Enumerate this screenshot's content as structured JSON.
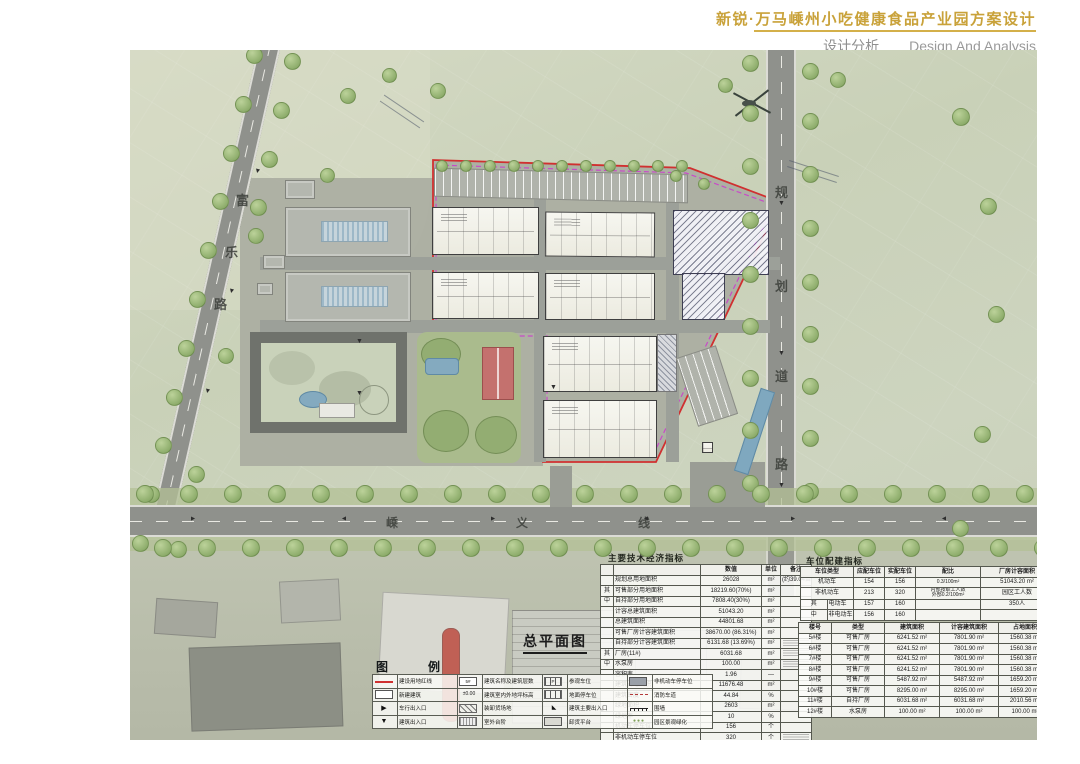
{
  "colors": {
    "accent_gold": "#C9A23A",
    "red_line": "#D03030",
    "magenta_line": "#C84BC8",
    "water": "#84AABF",
    "court_red": "#C4716E"
  },
  "header": {
    "project_title": "新锐·万马嵊州小吃健康食品产业园方案设计",
    "section_cn": "设计分析",
    "section_en": "Design And Analysis",
    "page_title": "总平面图"
  },
  "plan": {
    "label": "总平面图",
    "roads": {
      "west": "富乐路",
      "east": "规划道路",
      "south": "嵊义线"
    }
  },
  "main_table": {
    "title": "主要技术经济指标",
    "columns": [
      "",
      "数值",
      "单位",
      "备注"
    ],
    "rows": [
      {
        "p": "",
        "label": "规划总用地面积",
        "value": "26028",
        "unit": "m²",
        "note": "(约39.04亩)",
        "nb": false
      },
      {
        "p": "其",
        "label": "可售部分用地面积",
        "value": "18219.60(70%)",
        "unit": "m²",
        "note": "",
        "nb": false
      },
      {
        "p": "中",
        "label": "自持部分用地面积",
        "value": "7808.40(30%)",
        "unit": "m²",
        "note": "",
        "nb": false
      },
      {
        "p": "",
        "label": "计容总建筑面积",
        "value": "51043.20",
        "unit": "m²",
        "note": "",
        "nb": false
      },
      {
        "p": "",
        "label": "总建筑面积",
        "value": "44801.68",
        "unit": "m²",
        "note": "",
        "nb": false
      },
      {
        "p": "",
        "label": "可售厂房计容建筑面积",
        "value": "38670.00 (86.31%)",
        "unit": "m²",
        "note": "",
        "nb": false
      },
      {
        "p": "",
        "label": "自持部分计容建筑面积",
        "value": "6131.68 (13.69%)",
        "unit": "m²",
        "note": "",
        "nb": true
      },
      {
        "p": "其",
        "label": "厂房(11#)",
        "value": "6031.68",
        "unit": "m²",
        "note": "",
        "nb": true
      },
      {
        "p": "中",
        "label": "水泵房",
        "value": "100.00",
        "unit": "m²",
        "note": "",
        "nb": true
      },
      {
        "p": "",
        "label": "容积率",
        "value": "1.96",
        "unit": "—",
        "note": "",
        "nb": false
      },
      {
        "p": "",
        "label": "建筑占地面积",
        "value": "11676.48",
        "unit": "m²",
        "note": "",
        "nb": false
      },
      {
        "p": "",
        "label": "建筑密度",
        "value": "44.84",
        "unit": "%",
        "note": "",
        "nb": false
      },
      {
        "p": "",
        "label": "绿地面积",
        "value": "2603",
        "unit": "m²",
        "note": "",
        "nb": false
      },
      {
        "p": "",
        "label": "绿地率",
        "value": "10",
        "unit": "%",
        "note": "",
        "nb": false
      },
      {
        "p": "",
        "label": "机动车停车位",
        "value": "156",
        "unit": "个",
        "note": "",
        "nb": false
      },
      {
        "p": "",
        "label": "非机动车停车位",
        "value": "320",
        "unit": "个",
        "note": "",
        "nb": true
      }
    ]
  },
  "parking_table": {
    "title": "车位配建指标",
    "columns": [
      "车位类型",
      "应配车位",
      "实配车位",
      "配比",
      "厂房计容面积"
    ],
    "rows": [
      {
        "p": "",
        "type": "机动车",
        "req": "154",
        "act": "156",
        "ratio": [
          "0.3/100m²"
        ],
        "right": "51043.20 m²"
      },
      {
        "p": "",
        "type": "非机动车",
        "req": "213",
        "act": "320",
        "ratio": [
          "内部按职工人数",
          "外部0.2/100m²"
        ],
        "right": "园区工人数"
      },
      {
        "p": "其",
        "type": "电动车",
        "req": "157",
        "act": "160",
        "ratio": [],
        "right": "350人"
      },
      {
        "p": "中",
        "type": "非电动车",
        "req": "156",
        "act": "160",
        "ratio": [],
        "right": ""
      }
    ]
  },
  "building_table": {
    "columns": [
      "楼号",
      "类型",
      "建筑面积",
      "计容建筑面积",
      "占地面积"
    ],
    "rows": [
      [
        "5#楼",
        "可售厂房",
        "6241.52 m²",
        "7801.90 m²",
        "1560.38 m²"
      ],
      [
        "6#楼",
        "可售厂房",
        "6241.52 m²",
        "7801.90 m²",
        "1560.38 m²"
      ],
      [
        "7#楼",
        "可售厂房",
        "6241.52 m²",
        "7801.90 m²",
        "1560.38 m²"
      ],
      [
        "8#楼",
        "可售厂房",
        "6241.52 m²",
        "7801.90 m²",
        "1560.38 m²"
      ],
      [
        "9#楼",
        "可售厂房",
        "5487.92 m²",
        "5487.92 m²",
        "1659.20 m²"
      ],
      [
        "10#楼",
        "可售厂房",
        "8295.00 m²",
        "8295.00 m²",
        "1659.20 m²"
      ],
      [
        "11#楼",
        "自持厂房",
        "6031.68 m²",
        "6031.68 m²",
        "2010.56 m²"
      ],
      [
        "12#楼",
        "水泵房",
        "100.00 m²",
        "100.00 m²",
        "100.00 m²"
      ]
    ]
  },
  "legend": {
    "title": "图　例",
    "items": [
      {
        "icon": "red-line",
        "label": "建设用地红线"
      },
      {
        "icon": "label-box",
        "label": "建筑名称及建筑层数"
      },
      {
        "icon": "stall-p",
        "label": "参观车位"
      },
      {
        "icon": "dark",
        "label": "非机动车停车位"
      },
      {
        "icon": "white-box",
        "label": "新建建筑"
      },
      {
        "icon": "level",
        "label": "建筑室内外地坪标高"
      },
      {
        "icon": "stall",
        "label": "地面停车位"
      },
      {
        "icon": "dashed",
        "label": "消防车道"
      },
      {
        "icon": "arrow-right",
        "label": "车行出入口"
      },
      {
        "icon": "hatch",
        "label": "装卸货场地"
      },
      {
        "icon": "door",
        "label": "建筑主要出入口"
      },
      {
        "icon": "wall",
        "label": "围墙"
      },
      {
        "icon": "tri-down",
        "label": "建筑出入口"
      },
      {
        "icon": "steps",
        "label": "室外台阶"
      },
      {
        "icon": "dock",
        "label": "卸货平台"
      },
      {
        "icon": "circles",
        "label": "园区景观绿化"
      }
    ]
  }
}
